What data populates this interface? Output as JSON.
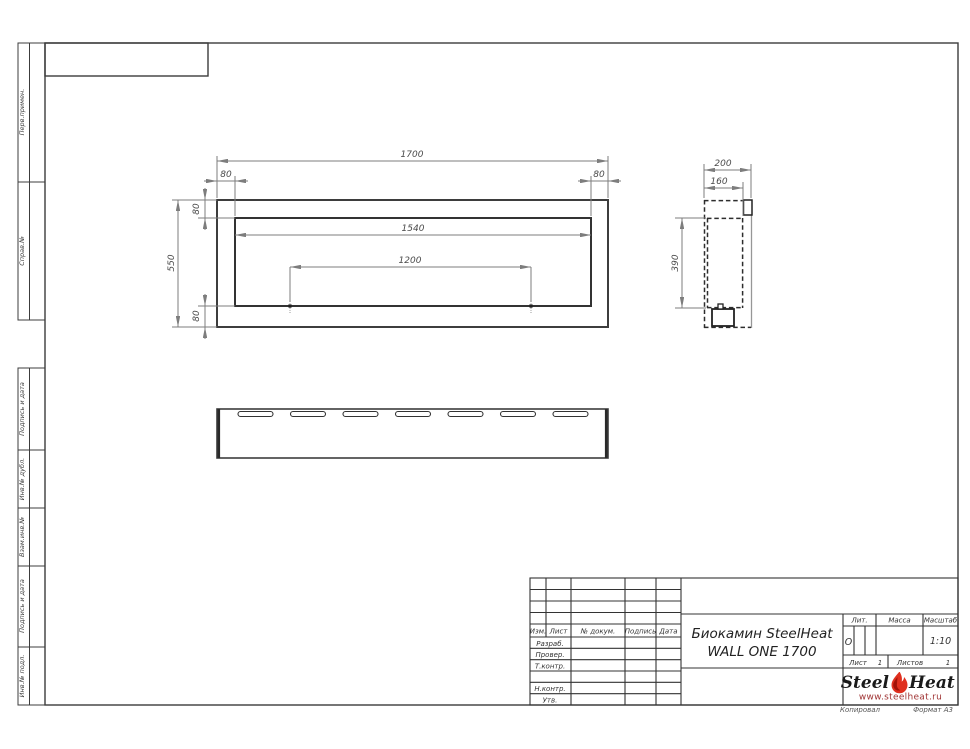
{
  "sheet": {
    "copied_label": "Копировал",
    "format_label": "Формат А3"
  },
  "margin_columns": {
    "top": [
      {
        "label": "Перв.примен."
      },
      {
        "label": "Справ.№"
      }
    ],
    "bottom": [
      {
        "label": "Подпись и дата"
      },
      {
        "label": "Инв.№ дубл."
      },
      {
        "label": "Взам.инв.№"
      },
      {
        "label": "Подпись и дата"
      },
      {
        "label": "Инв.№ подл."
      }
    ]
  },
  "dims": {
    "front_width": "1700",
    "front_height": "550",
    "inner_width": "1540",
    "mount_spacing": "1200",
    "wall_top_left": "80",
    "wall_top_right": "80",
    "wall_vert_top": "80",
    "wall_vert_bottom": "80",
    "depth": "200",
    "inner_depth": "160",
    "firebox_height": "390"
  },
  "title_block": {
    "header_cols": [
      "Изм.",
      "Лист",
      "№ докум.",
      "Подпись",
      "Дата"
    ],
    "row_labels": [
      "Разраб.",
      "Провер.",
      "Т.контр.",
      "Н.контр.",
      "Утв."
    ],
    "doc_title_line1": "Биокамин SteelHeat",
    "doc_title_line2": "WALL ONE 1700",
    "lit_label": "Лит.",
    "lit_value": "О",
    "mass_label": "Масса",
    "scale_label": "Масштаб",
    "scale_value": "1:10",
    "sheet_label": "Лист",
    "sheet_value": "1",
    "sheets_label": "Листов",
    "sheets_value": "1",
    "logo": {
      "steel": "Steel",
      "heat": "Heat",
      "url": "www.steelheat.ru"
    }
  },
  "colors": {
    "line_dark": "#3c3c3c",
    "line_dim": "#7d7d7d",
    "flame_red": "#e0301f",
    "flame_dark": "#a21208",
    "url_red": "#a03434"
  }
}
